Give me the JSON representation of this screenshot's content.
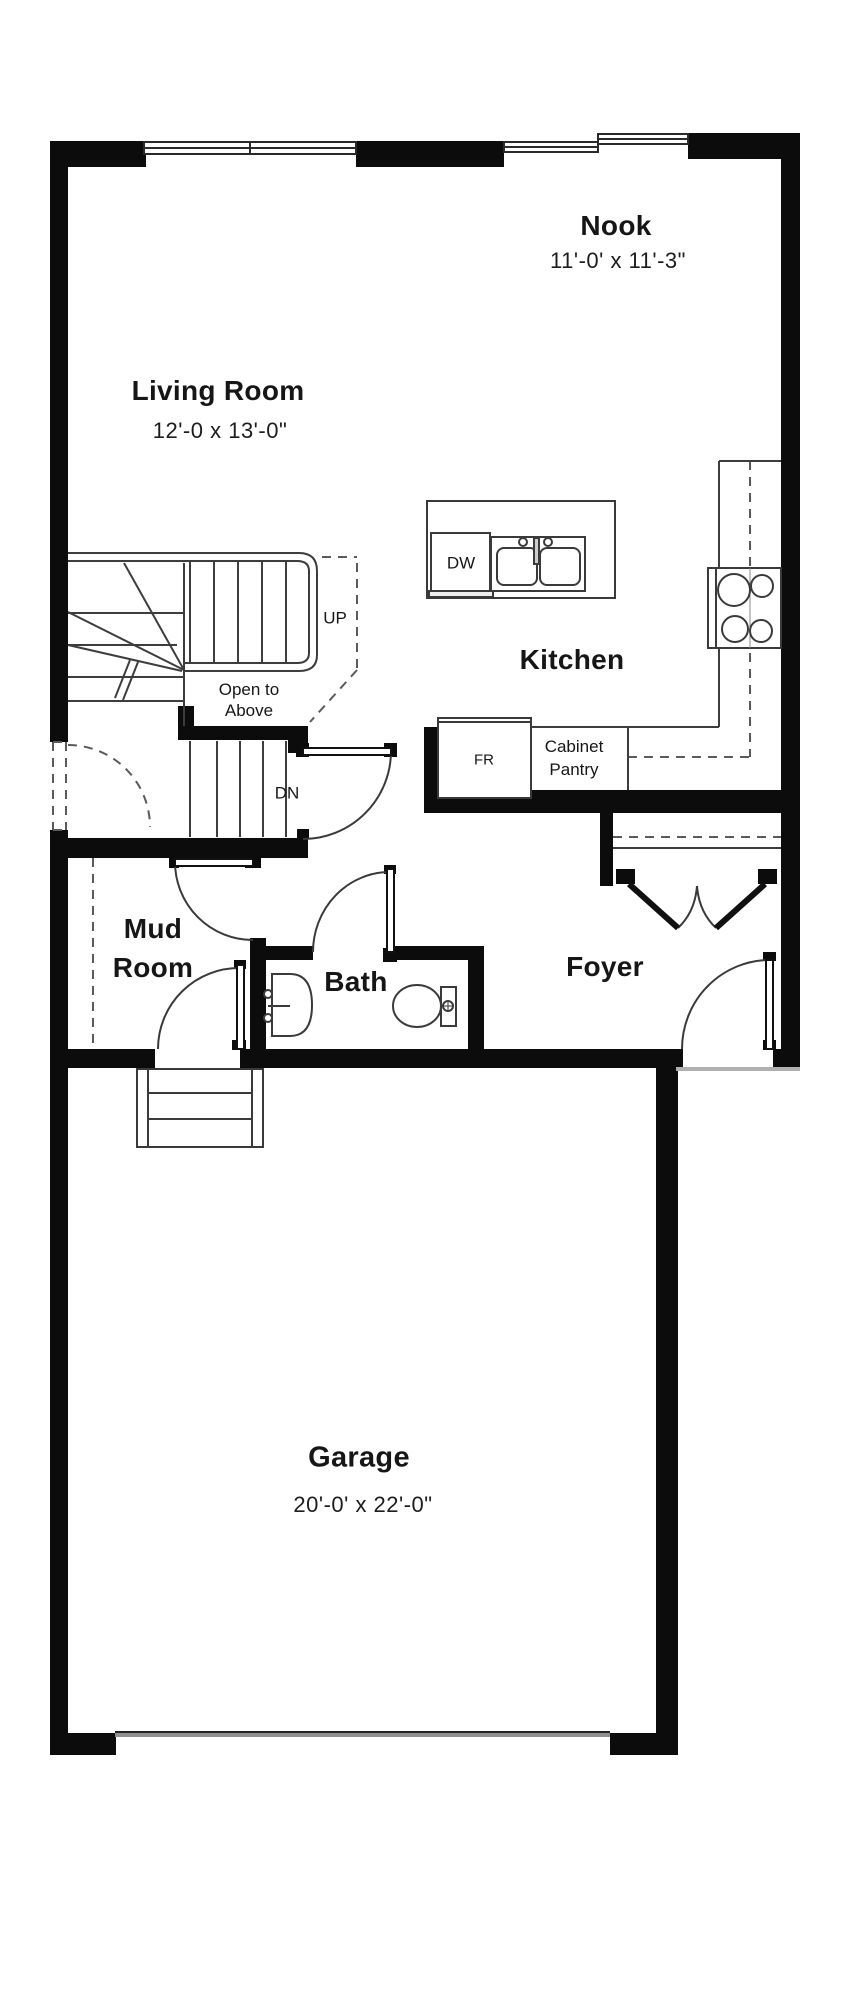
{
  "plan_title": "First Floor Plan",
  "colors": {
    "wall": "#0c0c0c",
    "line": "#3d3d3d",
    "dashed_line": "#5a5a5a",
    "sill": "#9a9a9a",
    "text": "#161616",
    "background": "#ffffff"
  },
  "rooms": {
    "nook": {
      "name": "Nook",
      "dims": "11'-0' x 11'-3\""
    },
    "living": {
      "name": "Living Room",
      "dims": "12'-0 x 13'-0\""
    },
    "kitchen": {
      "name": "Kitchen"
    },
    "mud": {
      "line1": "Mud",
      "line2": "Room"
    },
    "bath": {
      "name": "Bath"
    },
    "foyer": {
      "name": "Foyer"
    },
    "garage": {
      "name": "Garage",
      "dims": "20'-0' x 22'-0\""
    }
  },
  "annotations": {
    "up": "UP",
    "dn": "DN",
    "open_to_above": {
      "line1": "Open to",
      "line2": "Above"
    },
    "dishwasher": "DW",
    "fridge": "FR",
    "pantry": {
      "line1": "Cabinet",
      "line2": "Pantry"
    }
  }
}
